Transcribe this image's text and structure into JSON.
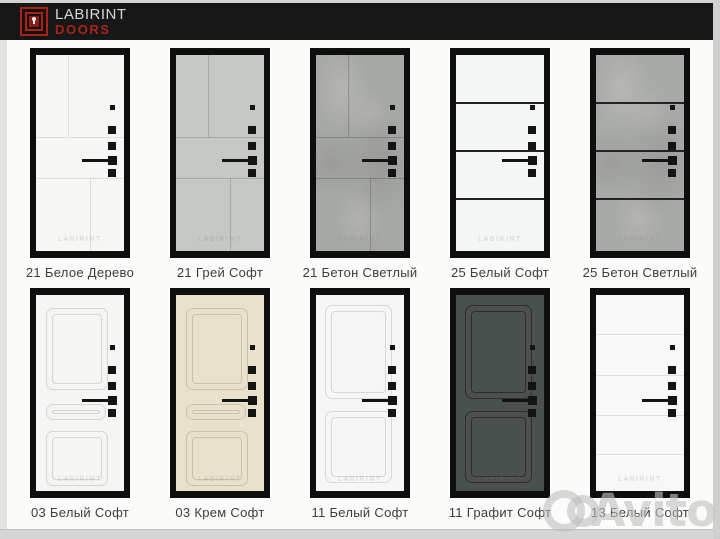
{
  "header": {
    "brand_name": "LABIRINT",
    "brand_sub": "DOORS",
    "logo_icon": "labyrinth-keyhole-icon",
    "bg_color": "#171717",
    "brand_name_color": "#d6d6d6",
    "brand_sub_color": "#a8241b"
  },
  "catalog": {
    "door_watermark": "LABIRINT",
    "doors": [
      {
        "label": "21 Белое Дерево",
        "model": "21",
        "finish": "Белое Дерево",
        "face_color": "#f6f6f4",
        "groove_color": "rgba(0,0,0,0.10)",
        "texture": "smooth"
      },
      {
        "label": "21 Грей Софт",
        "model": "21",
        "finish": "Грей Софт",
        "face_color": "#c6c8c3",
        "groove_color": "rgba(0,0,0,0.15)",
        "texture": "smooth"
      },
      {
        "label": "21 Бетон Светлый",
        "model": "21",
        "finish": "Бетон Светлый",
        "face_color": "#a6a8a5",
        "groove_color": "rgba(0,0,0,0.18)",
        "texture": "concrete"
      },
      {
        "label": "25 Белый Софт",
        "model": "25",
        "finish": "Белый Софт",
        "face_color": "#f4f5f5",
        "groove_color": "#232323",
        "texture": "smooth"
      },
      {
        "label": "25 Бетон Светлый",
        "model": "25",
        "finish": "Бетон Светлый",
        "face_color": "#a8aaa7",
        "groove_color": "#232323",
        "texture": "concrete"
      },
      {
        "label": "03 Белый Софт",
        "model": "03",
        "finish": "Белый Софт",
        "face_color": "#f5f5f4",
        "groove_color": "rgba(0,0,0,0.13)",
        "texture": "smooth"
      },
      {
        "label": "03 Крем Софт",
        "model": "03",
        "finish": "Крем Софт",
        "face_color": "#eae1cb",
        "groove_color": "rgba(0,0,0,0.14)",
        "texture": "smooth"
      },
      {
        "label": "11 Белый Софт",
        "model": "11",
        "finish": "Белый Софт",
        "face_color": "#f6f6f6",
        "groove_color": "rgba(0,0,0,0.12)",
        "texture": "smooth"
      },
      {
        "label": "11 Графит Софт",
        "model": "11",
        "finish": "Графит Софт",
        "face_color": "#4a504e",
        "groove_color": "rgba(0,0,0,0.42)",
        "texture": "smooth"
      },
      {
        "label": "13 Белый Софт",
        "model": "13",
        "finish": "Белый Софт",
        "face_color": "#f8f8f8",
        "groove_color": "rgba(0,0,0,0.10)",
        "texture": "smooth"
      }
    ]
  },
  "photo_watermark": {
    "text": "Avito"
  }
}
